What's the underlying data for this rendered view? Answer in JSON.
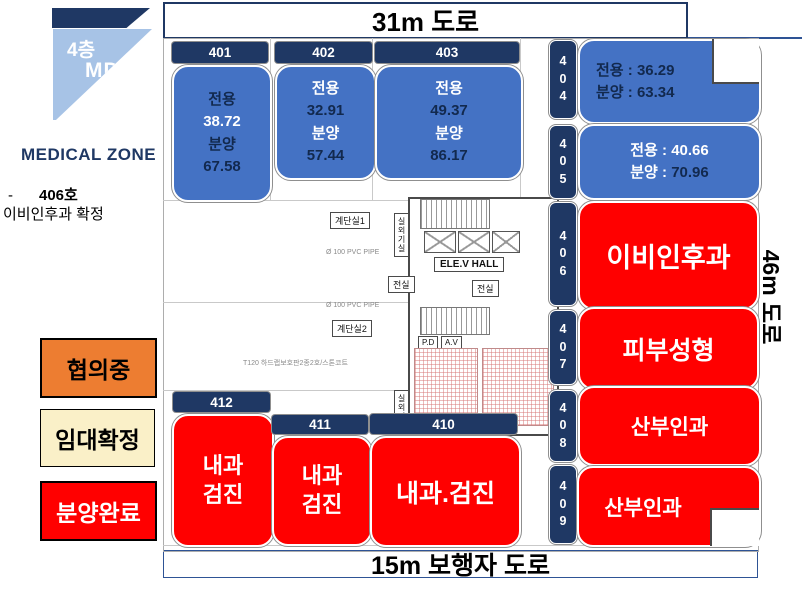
{
  "sidebar": {
    "flag": {
      "floor": "4층",
      "md": "MD"
    },
    "zone_title": "MEDICAL ZONE",
    "note": {
      "dash": "-",
      "room": "406호",
      "line2": "이비인후과 확정"
    },
    "legend": {
      "negotiating": "협의중",
      "lease_confirmed": "임대확정",
      "sold_out": "분양완료"
    }
  },
  "roads": {
    "top": "31m 도로",
    "right": "46m 도로",
    "bottom": "15m 보행자 도로"
  },
  "units": {
    "u401": {
      "no": "401",
      "area_label": "전용",
      "area": "38.72",
      "sale_label": "분양",
      "sale": "67.58"
    },
    "u402": {
      "no": "402",
      "area_label": "전용",
      "area": "32.91",
      "sale_label": "분양",
      "sale": "57.44"
    },
    "u403": {
      "no": "403",
      "area_label": "전용",
      "area": "49.37",
      "sale_label": "분양",
      "sale": "86.17"
    },
    "u404": {
      "d1": "4",
      "d2": "0",
      "d3": "4",
      "area_label": "전용 : ",
      "area": "36.29",
      "sale_label": "분양 : ",
      "sale": "63.34"
    },
    "u405": {
      "d1": "4",
      "d2": "0",
      "d3": "5",
      "area_label": "전용 : ",
      "area": "40.66",
      "sale_label": "분양 : ",
      "sale": "70.96"
    },
    "u406": {
      "d1": "4",
      "d2": "0",
      "d3": "6",
      "tenant": "이비인후과"
    },
    "u407": {
      "d1": "4",
      "d2": "0",
      "d3": "7",
      "tenant": "피부성형"
    },
    "u408": {
      "d1": "4",
      "d2": "0",
      "d3": "8",
      "tenant": "산부인과"
    },
    "u409": {
      "d1": "4",
      "d2": "0",
      "d3": "9",
      "tenant": "산부인과"
    },
    "u410": {
      "no": "410",
      "tenant": "내과.검진"
    },
    "u411": {
      "no": "411",
      "tenant_l1": "내과",
      "tenant_l2": "검진"
    },
    "u412": {
      "no": "412",
      "tenant_l1": "내과",
      "tenant_l2": "검진"
    }
  },
  "floorplan": {
    "stair1": "계단실1",
    "stair2": "계단실2",
    "outdoor1": "실외기실",
    "outdoor2": "실외기실",
    "elev_hall": "ELE.V HALL",
    "vestibule_l": "전실",
    "vestibule_r": "전실",
    "pipe1": "Ø 100 PVC PIPE",
    "pipe2": "Ø 100 PVC PIPE",
    "finish": "T120 하드랩보호판2종2호/스톤코트",
    "pd": "P.D",
    "av": "A.V"
  },
  "colors": {
    "navy": "#1F3864",
    "blue": "#4472C4",
    "red": "#FF0000",
    "light_blue": "#A7C3E6",
    "orange": "#ED7D31",
    "pale_yellow": "#FAF0C8"
  }
}
